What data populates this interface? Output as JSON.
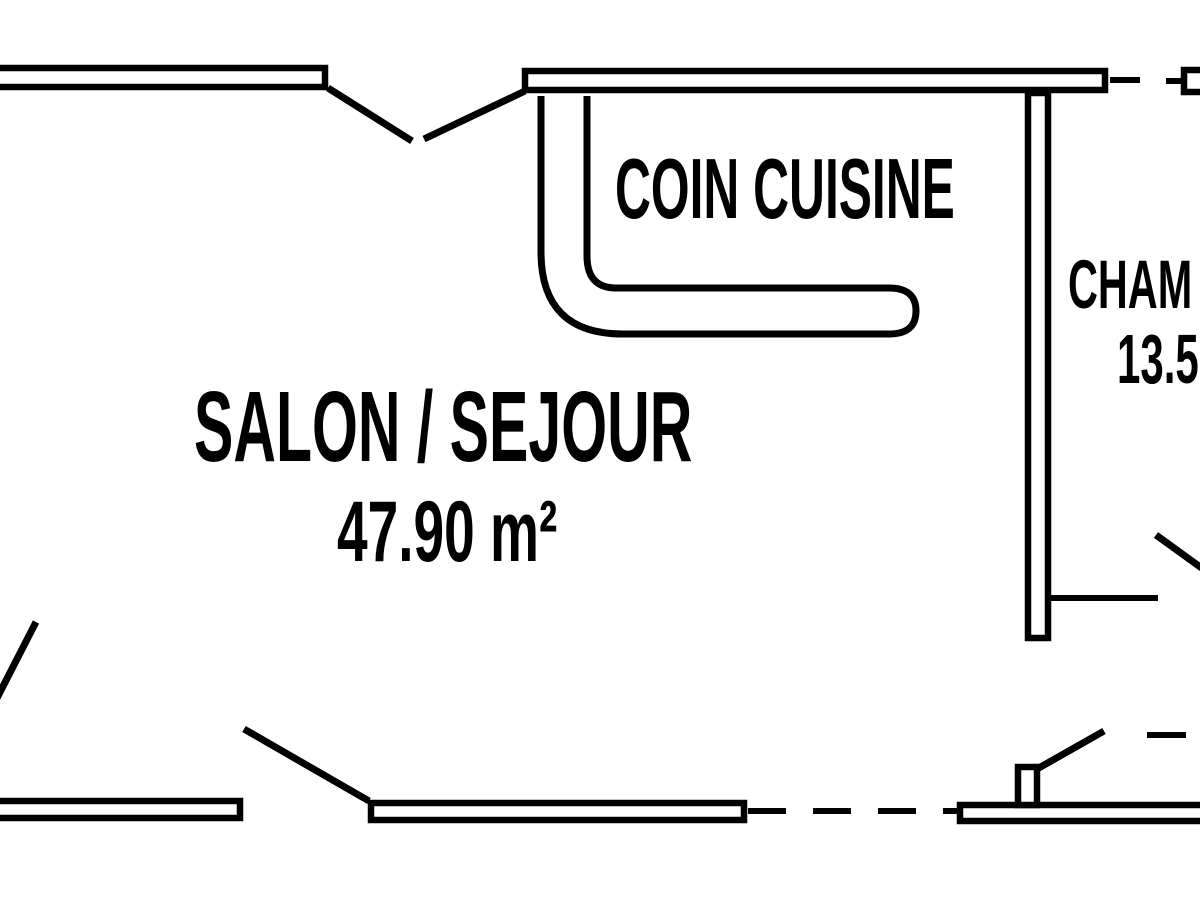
{
  "title": "Apartment floor plan",
  "colors": {
    "line": "#000000",
    "background": "#ffffff"
  },
  "rooms": {
    "salon": {
      "name": "SALON / SEJOUR",
      "area": "47.90 m²"
    },
    "cuisine": {
      "name": "COIN CUISINE"
    },
    "chambre": {
      "name": "CHAM",
      "area": "13.5"
    }
  }
}
